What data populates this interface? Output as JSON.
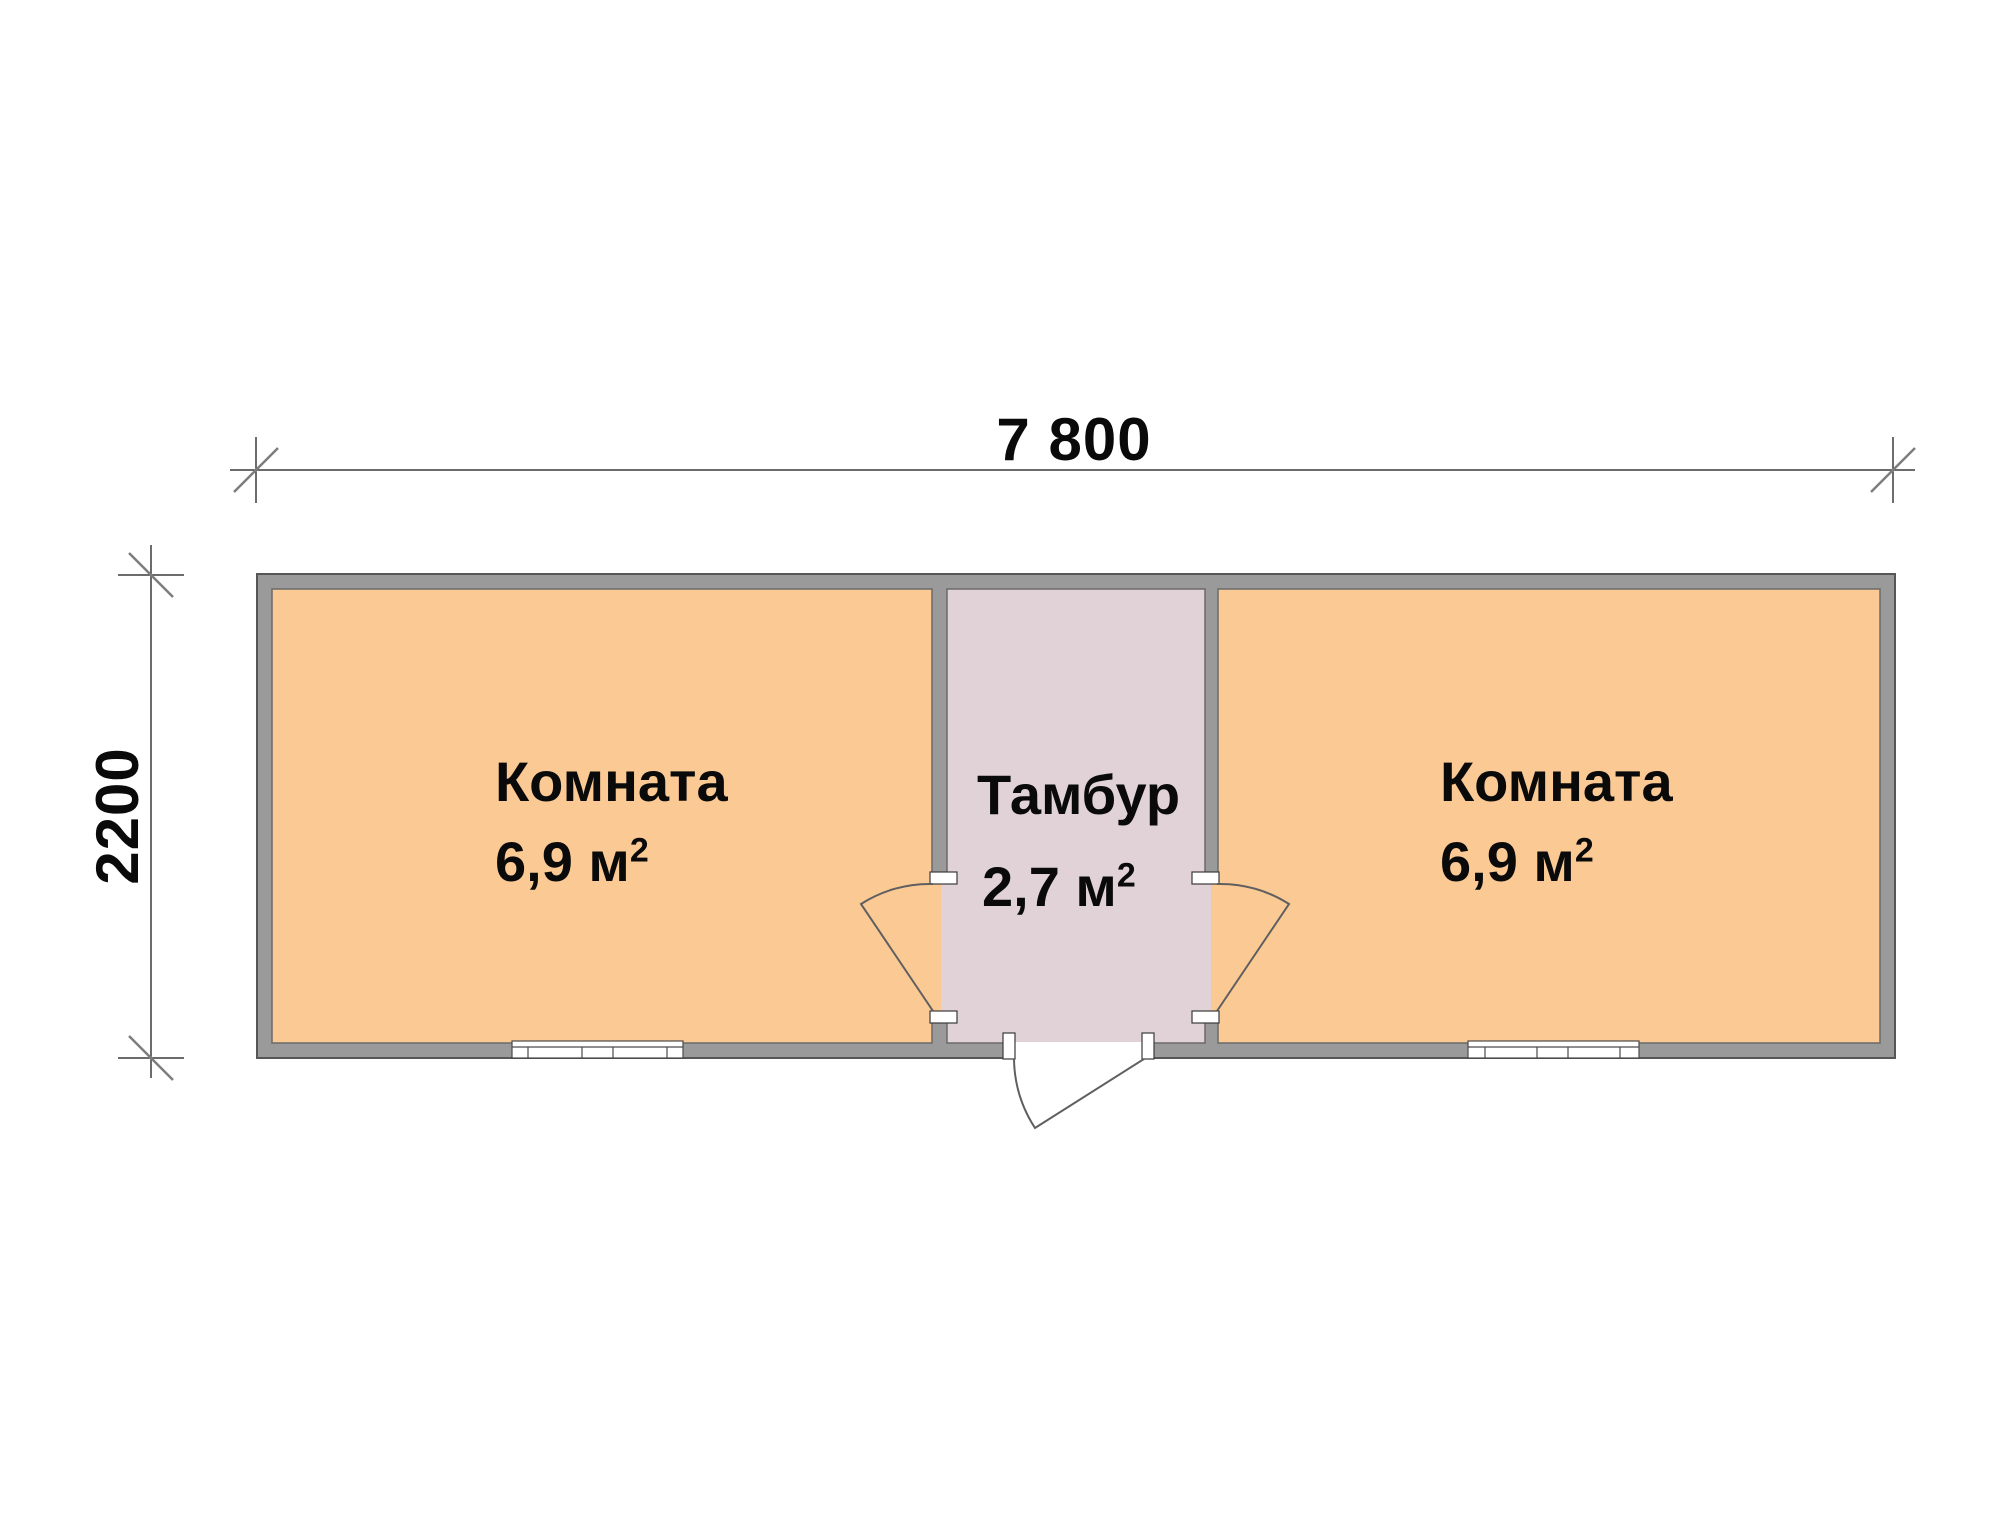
{
  "type": "floor-plan",
  "dimensions": {
    "width_label": "7 800",
    "height_label": "2200"
  },
  "rooms": [
    {
      "name": "Комната",
      "area": "6,9 м",
      "area_sup": "2"
    },
    {
      "name": "Тамбур",
      "area": "2,7 м",
      "area_sup": "2"
    },
    {
      "name": "Комната",
      "area": "6,9 м",
      "area_sup": "2"
    }
  ],
  "colors": {
    "background": "#ffffff",
    "room_fill": "#fbc994",
    "vestibule_fill": "#e0d2d7",
    "wall_fill": "#9a9a9a",
    "wall_outline": "#565656",
    "line": "#3c3c3c",
    "text": "#0a0a0a"
  }
}
